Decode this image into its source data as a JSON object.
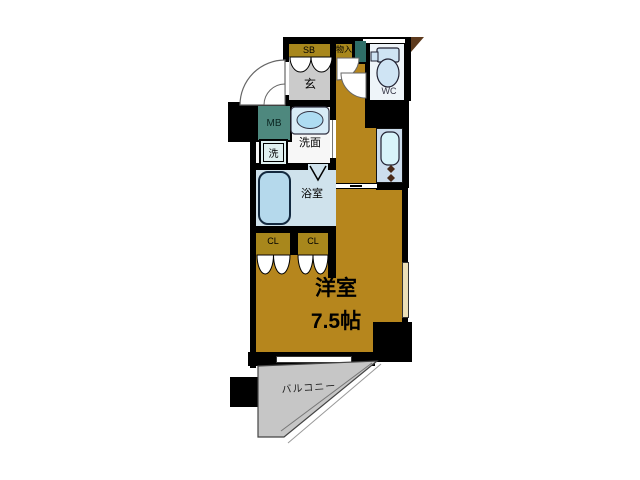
{
  "rooms": {
    "shoe_box": {
      "label": "SB"
    },
    "storage": {
      "label": "物入"
    },
    "entrance": {
      "label": "玄"
    },
    "toilet": {
      "label": "WC"
    },
    "meter_box": {
      "label": "MB"
    },
    "washroom": {
      "label": "洗面"
    },
    "washer": {
      "label": "洗"
    },
    "bathroom": {
      "label": "浴室"
    },
    "closet_left": {
      "label": "CL"
    },
    "closet_right": {
      "label": "CL"
    },
    "western_room": {
      "label": "洋室",
      "size": "7.5帖"
    },
    "balcony": {
      "label": "バルコニー"
    }
  },
  "colors": {
    "room_floor": "#b6861d",
    "closet_floor": "#a8871c",
    "entrance_floor": "#cbcbcb",
    "bathroom_floor": "#cfe2ec",
    "bathtub": "#b5d9ec",
    "fixture_blue": "#aedcf2",
    "kitchen_counter": "#ccdded",
    "meter_box": "#4e887e",
    "pipe_space": "#2f6e68",
    "balcony_floor": "#c6c6c6",
    "wall": "#000000"
  }
}
